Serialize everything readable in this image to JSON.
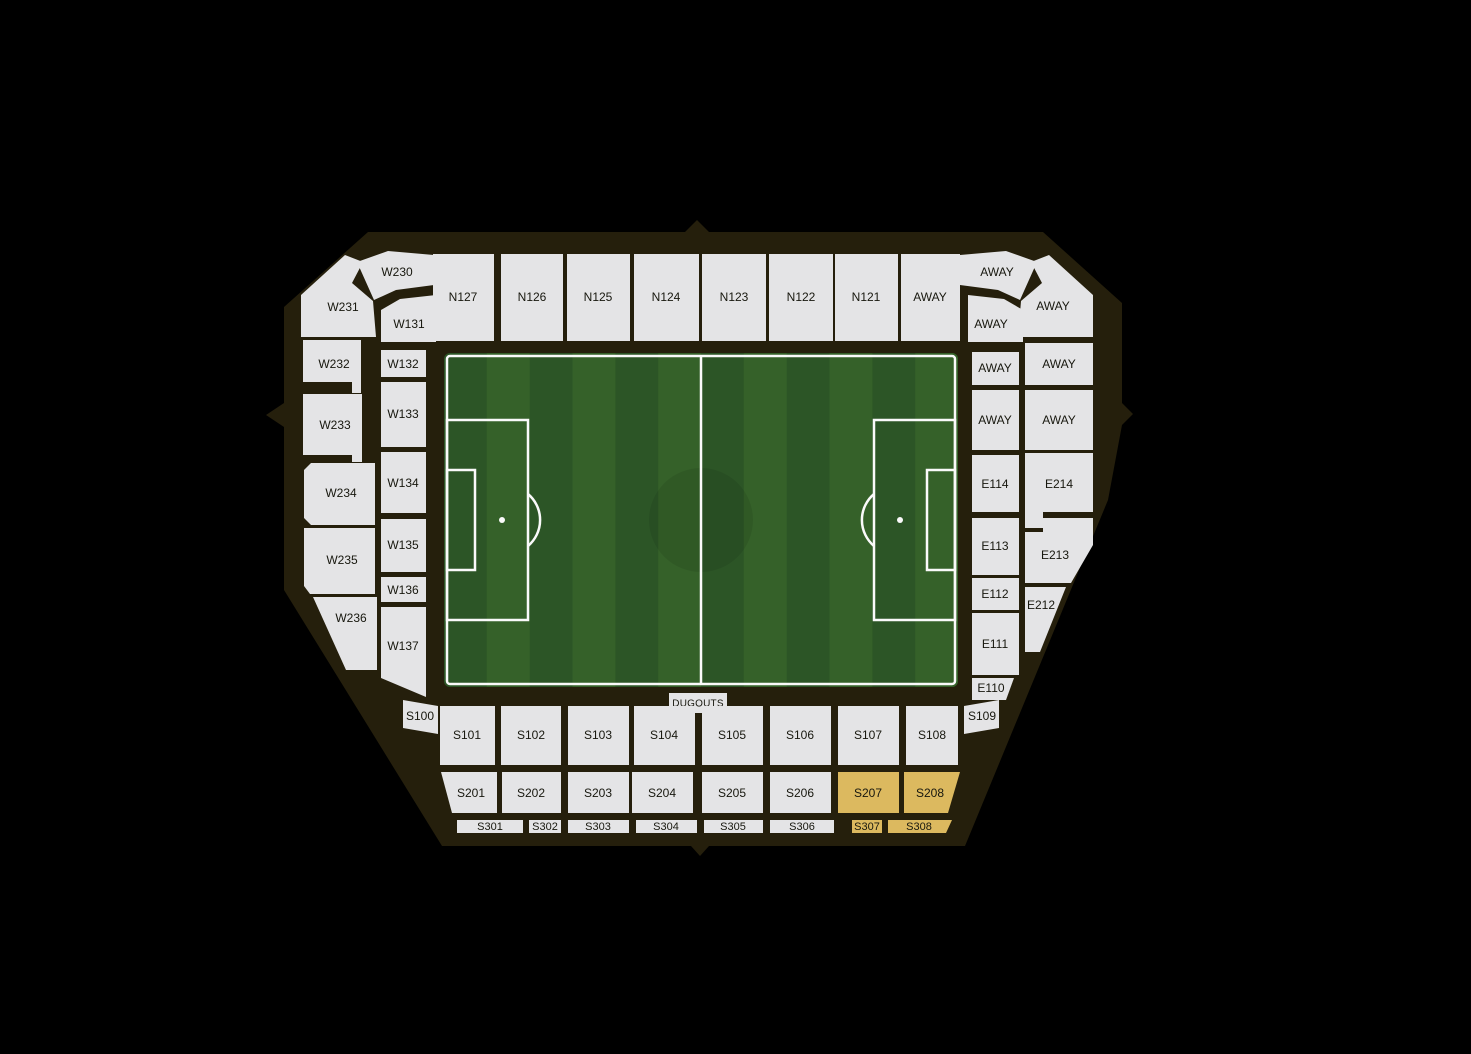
{
  "colors": {
    "background": "#000000",
    "bowl": "#251f0c",
    "section_fill": "#e4e4e6",
    "highlight_fill": "#dcb95f",
    "pitch_dark": "#2c5526",
    "pitch_light": "#356129",
    "pitch_line": "#fafafa",
    "label_text": "#17170e"
  },
  "pitch": {
    "dugouts_label": "DUGOUTS"
  },
  "north": {
    "labels": [
      "N127",
      "N126",
      "N125",
      "N124",
      "N123",
      "N122",
      "N121",
      "AWAY"
    ]
  },
  "nw": {
    "labels": [
      "W230",
      "W231",
      "W131"
    ]
  },
  "ne": {
    "labels": [
      "AWAY",
      "AWAY",
      "AWAY"
    ]
  },
  "west_outer": {
    "labels": [
      "W232",
      "W233",
      "W234",
      "W235",
      "W236"
    ]
  },
  "west_inner": {
    "labels": [
      "W132",
      "W133",
      "W134",
      "W135",
      "W136",
      "W137"
    ]
  },
  "east_inner": {
    "labels": [
      "AWAY",
      "AWAY",
      "E114",
      "E113",
      "E112",
      "E111",
      "E110"
    ]
  },
  "east_outer": {
    "labels": [
      "AWAY",
      "AWAY",
      "E214",
      "E213",
      "E212"
    ]
  },
  "south_tier1": {
    "labels": [
      "S100",
      "S101",
      "S102",
      "S103",
      "S104",
      "S105",
      "S106",
      "S107",
      "S108",
      "S109"
    ]
  },
  "south_tier2": {
    "labels": [
      "S201",
      "S202",
      "S203",
      "S204",
      "S205",
      "S206",
      "S207",
      "S208"
    ]
  },
  "south_tier3": {
    "labels": [
      "S301",
      "S302",
      "S303",
      "S304",
      "S305",
      "S306",
      "S307",
      "S308"
    ]
  },
  "highlighted_sections": [
    "S207",
    "S208",
    "S307",
    "S308"
  ]
}
